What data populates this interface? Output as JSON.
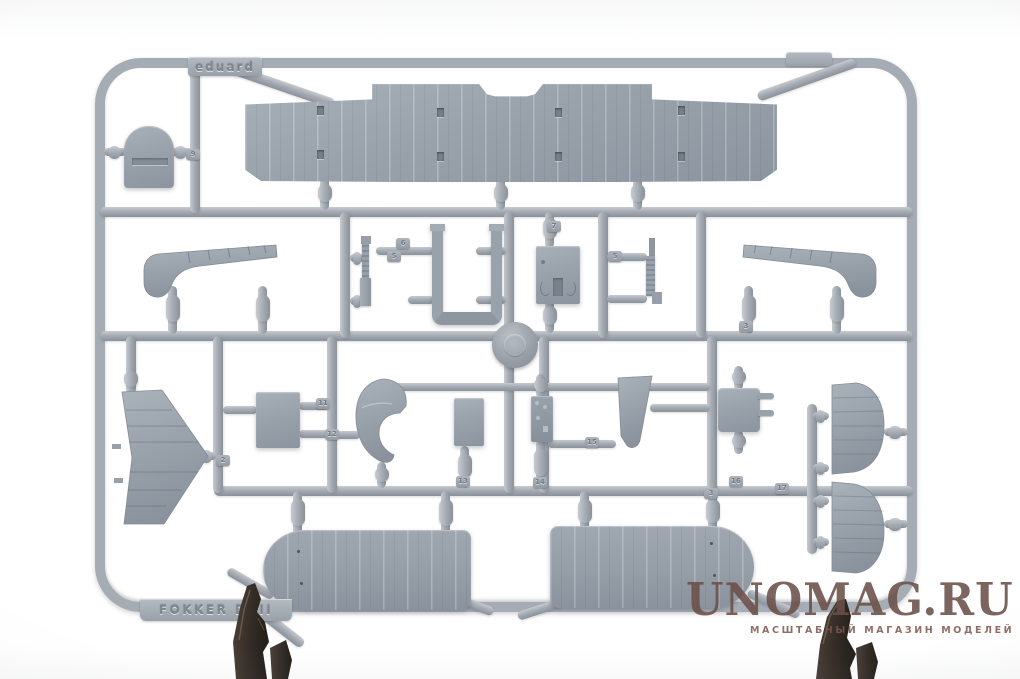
{
  "scene": {
    "type": "product-photo",
    "subject": "Gray injection-molded plastic model kit sprue with biplane aircraft parts on a white background",
    "background_color": "#ffffff"
  },
  "sprue": {
    "brand_text": "eduard",
    "kit_text": "FOKKER DVII",
    "number_tags": [
      {
        "label": "9"
      },
      {
        "label": "6"
      },
      {
        "label": "5"
      },
      {
        "label": "7"
      },
      {
        "label": "5"
      },
      {
        "label": "3"
      },
      {
        "label": "2"
      },
      {
        "label": "11"
      },
      {
        "label": "12"
      },
      {
        "label": "13"
      },
      {
        "label": "14"
      },
      {
        "label": "15"
      },
      {
        "label": "16"
      },
      {
        "label": "3"
      },
      {
        "label": "17"
      }
    ]
  },
  "watermark": {
    "title": "UNOMAG.RU",
    "subtitle": "МАСШТАБНЫЙ МАГАЗИН МОДЕЛЕЙ"
  },
  "colors": {
    "background": "#ffffff",
    "plastic": "#a6acb4",
    "plastic-light": "#c7cbd0",
    "plastic-dark": "#8a9199",
    "plastic-part": "#99a2ab",
    "dark-plastic": "#352d27",
    "dark-plastic-light": "#73624f",
    "watermark": "#6b4f49",
    "emboss-text": "#7f868f"
  }
}
